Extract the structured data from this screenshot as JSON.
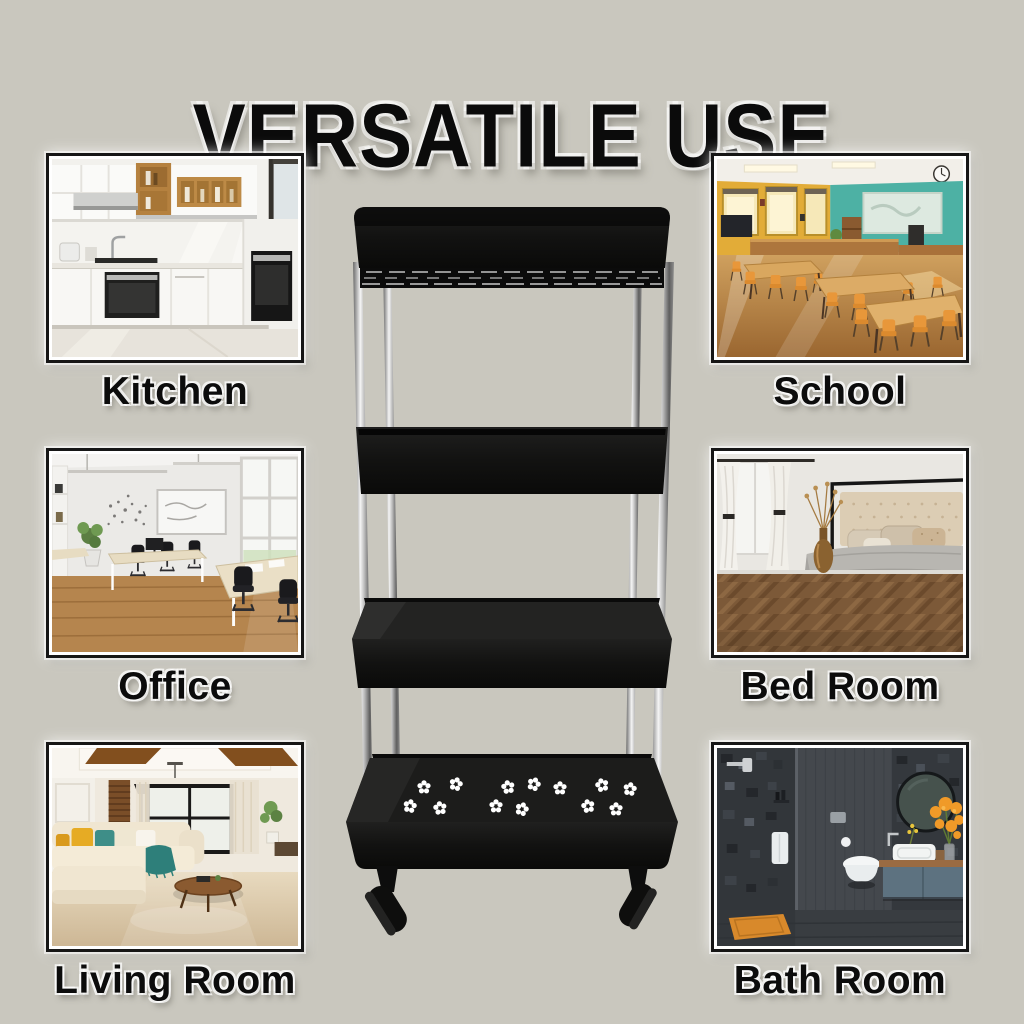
{
  "title": "VERSATILE USE",
  "rooms": [
    {
      "id": "kitchen",
      "label": "Kitchen"
    },
    {
      "id": "school",
      "label": "School"
    },
    {
      "id": "office",
      "label": "Office"
    },
    {
      "id": "bedroom",
      "label": "Bed Room"
    },
    {
      "id": "living-room",
      "label": "Living Room"
    },
    {
      "id": "bathroom",
      "label": "Bath Room"
    }
  ],
  "product": {
    "name": "four-tier-rolling-storage-cart",
    "tiers": 4
  },
  "colors": {
    "background": "#c9c7be",
    "title_text": "#0b0b0b",
    "label_text": "#0c0c0c",
    "photo_frame_border": "#161616",
    "cart_plastic": "#141414",
    "cart_pole_chrome": "#d7d7d7",
    "paw_perforation": "#ffffff"
  }
}
